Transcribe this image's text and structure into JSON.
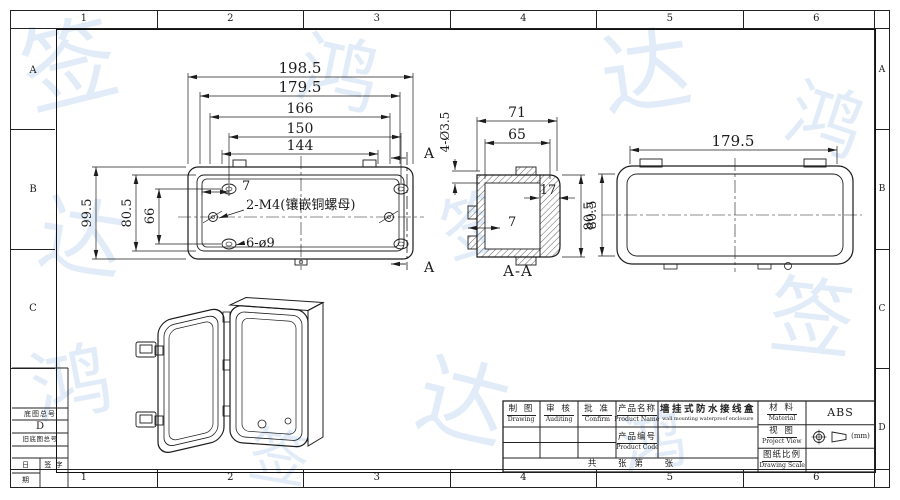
{
  "frame": {
    "zone_numbers": [
      "1",
      "2",
      "3",
      "4",
      "5",
      "6"
    ],
    "zone_letters": [
      "A",
      "B",
      "C",
      "D"
    ]
  },
  "views": {
    "front": {
      "width_dims": [
        "198.5",
        "179.5",
        "166",
        "150",
        "144"
      ],
      "height_dims": [
        "99.5",
        "80.5",
        "66"
      ],
      "edge_dim": "7",
      "thread_note": "2-M4(镶嵌铜螺母)",
      "hole_note": "6-ø9",
      "section_marker": "A"
    },
    "section": {
      "name": "A-A",
      "width_dims": [
        "71",
        "65"
      ],
      "cover_dim": "17",
      "flange_dim": "7",
      "height_dim": "80.5",
      "hole_note": "4-Ø3.5"
    },
    "side": {
      "width_dim": "179.5",
      "height_dim": "80.5"
    }
  },
  "title_block": {
    "drawing": {
      "zh": "制 图",
      "en": "Drawing"
    },
    "auditing": {
      "zh": "审 核",
      "en": "Auditing"
    },
    "confirm": {
      "zh": "批 准",
      "en": "Confirm"
    },
    "product_name_label": {
      "zh": "产品名称",
      "en": "Product Name"
    },
    "product_name_value": {
      "zh": "墙挂式防水接线盒",
      "en": "wall mounting waterproof enclosure"
    },
    "product_code_label": {
      "zh": "产品编号",
      "en": "Product Code"
    },
    "material": {
      "zh": "材 料",
      "en": "Material",
      "value": "ABS"
    },
    "view": {
      "zh": "视 图",
      "en": "Project View",
      "unit": "(mm)"
    },
    "scale": {
      "zh": "图纸比例",
      "en": "Drawing Scale"
    },
    "sheet_row": "共        张   第        张"
  },
  "corner_table": {
    "base_drawing_no": "底图总号",
    "zone": "D",
    "old_base_drawing_no": "旧底图总号",
    "date_top": "日",
    "date_bottom": "期",
    "signature": "签  字"
  },
  "watermark_glyphs": [
    "鸿",
    "达",
    "签"
  ]
}
